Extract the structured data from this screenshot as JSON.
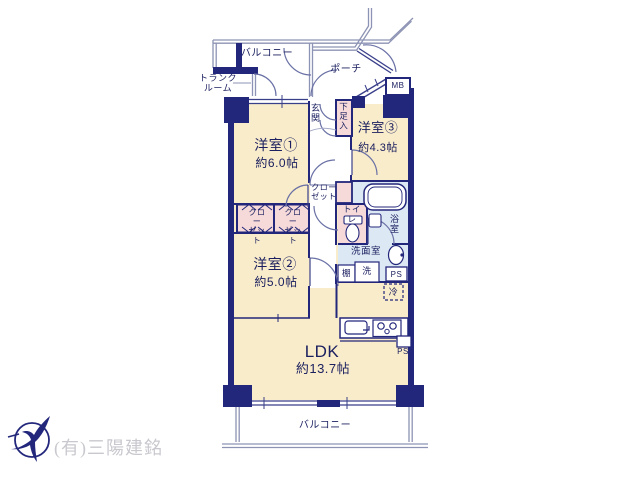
{
  "labels": {
    "balcony_top": "バルコニー",
    "balcony_bottom": "バルコニー",
    "trunk_room": "トランク\nルーム",
    "porch": "ポーチ",
    "meter_box": "MB",
    "entrance": "玄関",
    "shoe_cabinet": "下足入",
    "closet": "クロー\nゼット",
    "toilet": "トイレ",
    "bathroom": "浴室",
    "washroom": "洗面室",
    "shelf": "棚",
    "laundry": "洗",
    "fridge": "冷",
    "pipe_space_washroom": "PS",
    "pipe_space_kitchen": "PS",
    "company": "(有)三陽建銘"
  },
  "rooms": {
    "room1": {
      "name": "洋室①",
      "size": "約6.0帖"
    },
    "room2": {
      "name": "洋室②",
      "size": "約5.0帖"
    },
    "room3": {
      "name": "洋室③",
      "size": "約4.3帖"
    },
    "ldk": {
      "name": "LDK",
      "size": "約13.7帖"
    }
  },
  "colors": {
    "wall": "#23277b",
    "room_fill": "#f9ecca",
    "closet_fill": "#f6dada",
    "wet_fill": "#dce8f4",
    "text": "#1c2060",
    "muted_text": "#c8c8ce"
  }
}
